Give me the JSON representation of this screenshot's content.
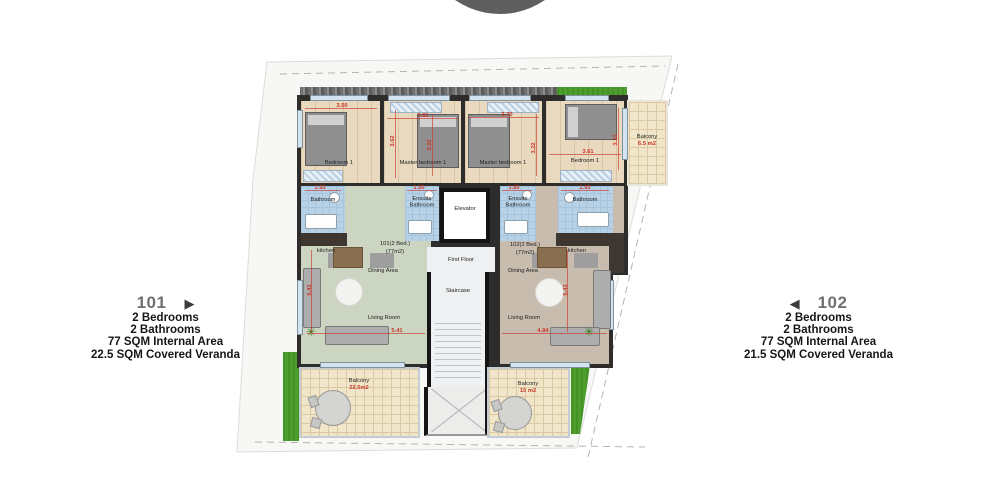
{
  "logo": {
    "color": "#5f5f5f"
  },
  "panels": {
    "left": {
      "unit": "101",
      "arrow": "▶",
      "lines": [
        "2 Bedrooms",
        "2 Bathrooms",
        "77 SQM Internal Area",
        "22.5 SQM Covered Veranda"
      ]
    },
    "right": {
      "unit": "102",
      "arrow": "◀",
      "lines": [
        "2 Bedrooms",
        "2 Bathrooms",
        "77 SQM Internal Area",
        "21.5 SQM Covered Veranda"
      ]
    }
  },
  "plan": {
    "floor_label": "First Floor",
    "elevator": "Elevator",
    "staircase": "Staircase",
    "apartments": {
      "a101": {
        "label": "101(2 Bed.)",
        "area": "(77m2)"
      },
      "a102": {
        "label": "102(2 Bed.)",
        "area": "(77m2)"
      }
    },
    "rooms": {
      "bedroom1_left": {
        "name": "Bedroom 1",
        "dim_w": "3.50",
        "dim_h": "3.62"
      },
      "master_left": {
        "name": "Master bedroom 1",
        "dim_w": "3.81",
        "dim_h": "3.22"
      },
      "master_right": {
        "name": "Master bedroom 1",
        "dim_w": "3.70",
        "dim_h": "3.22"
      },
      "bedroom1_right": {
        "name": "Bedroom 1",
        "dim_w": "3.61",
        "dim_h": "3.22"
      },
      "bathroom_left": {
        "name": "Bathroom",
        "dim_w": "1.93"
      },
      "ensuite_left": {
        "name": "Ensuite Bathroom",
        "dim_w": "1.50"
      },
      "ensuite_right": {
        "name": "Ensuite Bathroom",
        "dim_w": "1.85"
      },
      "bathroom_right": {
        "name": "Bathroom",
        "dim_w": "1.93"
      },
      "kitchen_left": {
        "name": "kitchen"
      },
      "kitchen_right": {
        "name": "kitchen"
      },
      "dining_left": {
        "name": "Dining Area"
      },
      "dining_right": {
        "name": "Dining Area"
      },
      "living_left": {
        "name": "Living Room",
        "dim_w": "5.41",
        "dim_h": "5.43"
      },
      "living_right": {
        "name": "Living Room",
        "dim_w": "4.84",
        "dim_h": "5.43"
      },
      "balcony_top": {
        "name": "Balcony",
        "area": "6.5 m2"
      },
      "balcony_left": {
        "name": "Balcony",
        "area": "22.5m2"
      },
      "balcony_right": {
        "name": "Balcony",
        "area": "15 m2"
      }
    }
  },
  "icons": {
    "plant": "✳"
  },
  "colors": {
    "dim_red": "#c9372b",
    "wall": "#2f2d2b",
    "floor_101": "#ccd5c1",
    "floor_102": "#c8bcae",
    "bathroom_blue": "#b7d1e7",
    "grass": "#4e9e2d"
  }
}
